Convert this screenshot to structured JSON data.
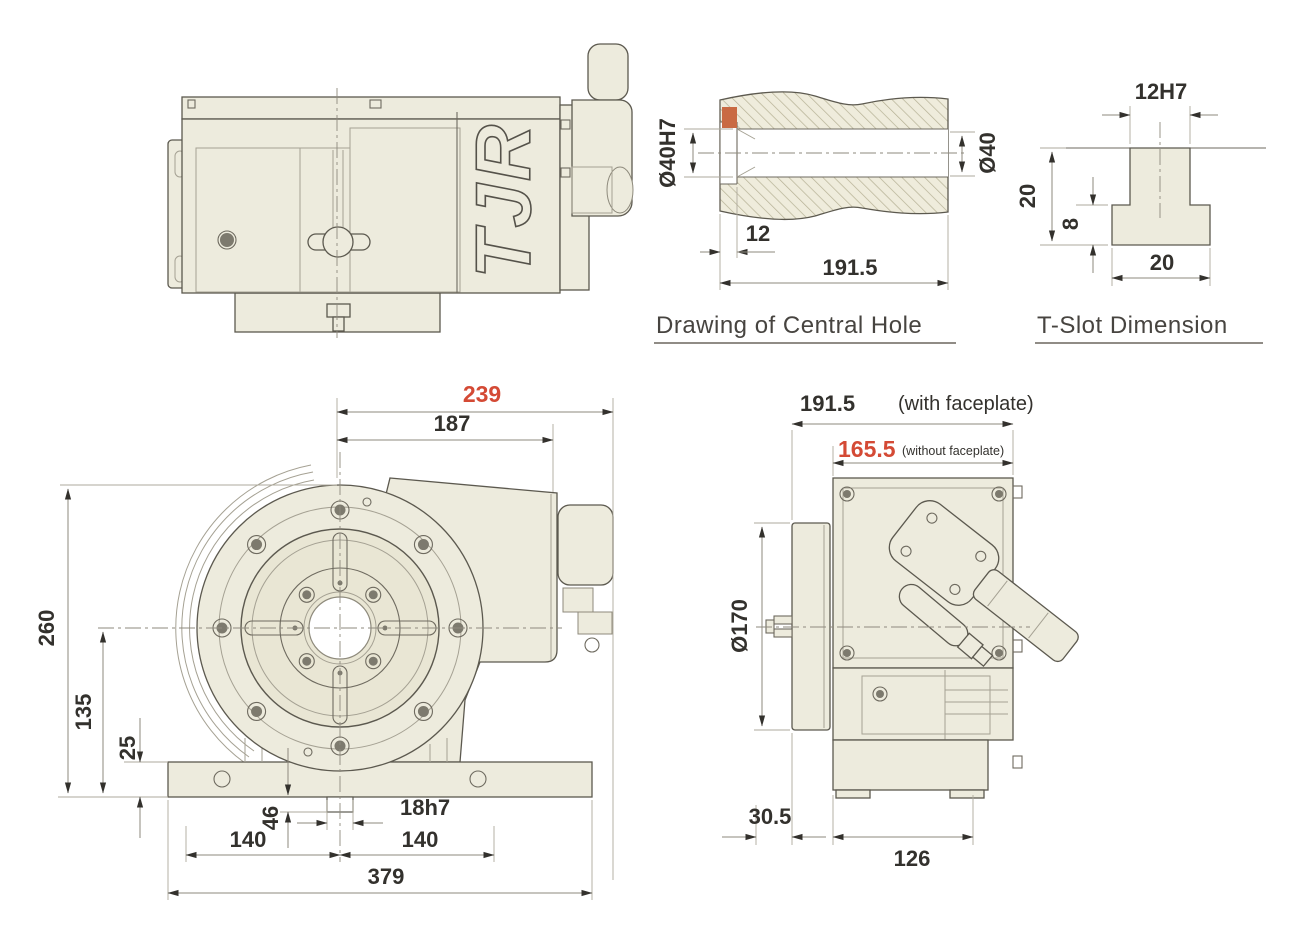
{
  "palette": {
    "part_fill": "#edebdd",
    "outline": "#5c594f",
    "dimension_text": "#33312d",
    "accent_red": "#d44a35",
    "section_marker_orange": "#c96a43",
    "hatch_line": "#b5b094"
  },
  "brand": {
    "logo": "TJR"
  },
  "central_hole_view": {
    "title": "Drawing of Central Hole",
    "bore_left": "Ø40H7",
    "bore_right": "Ø40",
    "counterbore_depth": "12",
    "total_length": "191.5"
  },
  "t_slot_view": {
    "title": "T-Slot Dimension",
    "slot_width": "12H7",
    "total_depth": "20",
    "flange_depth": "8",
    "base_width": "20"
  },
  "front_view": {
    "overall_width": "239",
    "body_width": "187",
    "total_height": "260",
    "center_height": "135",
    "base_thickness": "25",
    "key_height": "46",
    "key_width": "18h7",
    "mount_left": "140",
    "mount_right": "140",
    "base_width": "379"
  },
  "side_view": {
    "depth_with_faceplate": "191.5",
    "with_faceplate_note": "(with faceplate)",
    "depth_without_faceplate": "165.5",
    "without_faceplate_note": "(without faceplate)",
    "faceplate_diameter": "Ø170",
    "front_overhang": "30.5",
    "base_depth": "126"
  }
}
